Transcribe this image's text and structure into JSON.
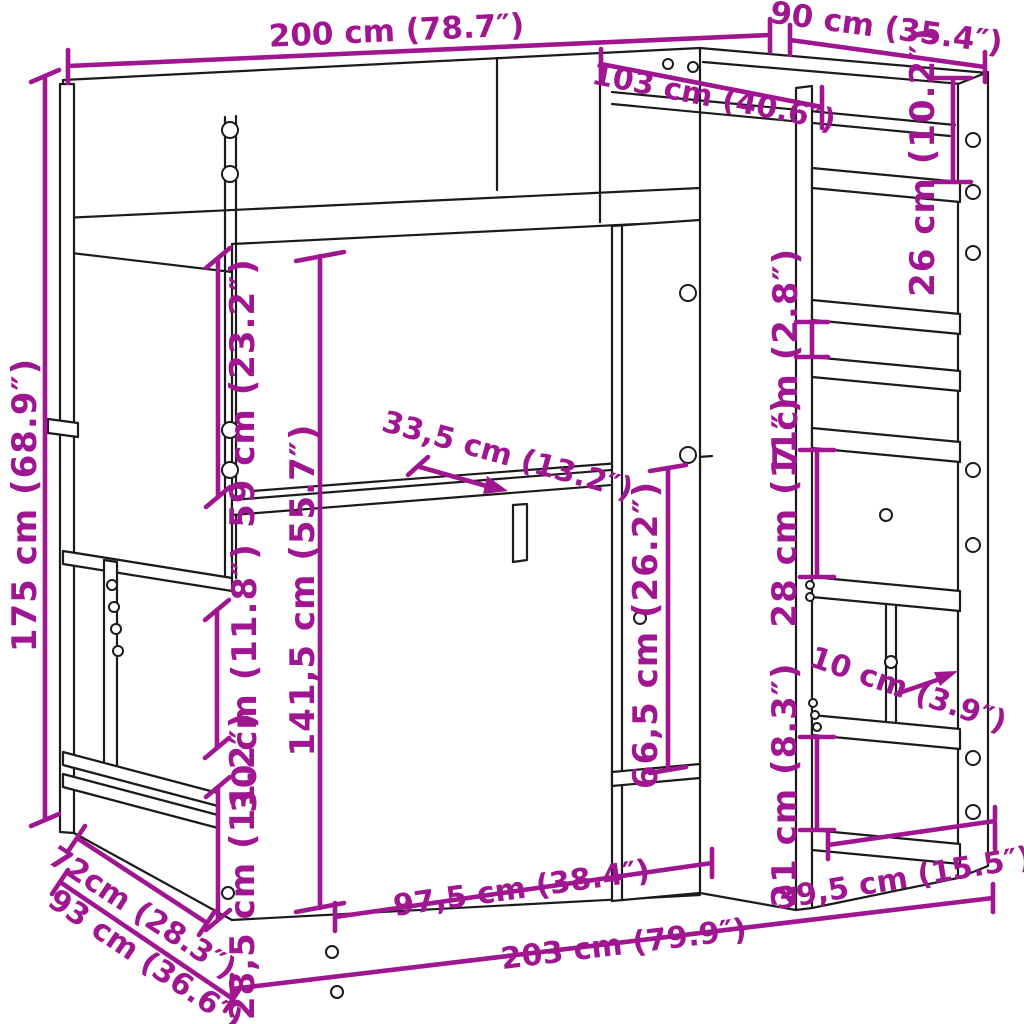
{
  "meta": {
    "subject": "loft-bed-with-desk-and-shelves dimension diagram",
    "background_color": "#ffffff",
    "line_color": "#1b1b1b",
    "dimension_color": "#A01590"
  },
  "dimensions": {
    "bed_top_length": {
      "label": "200 cm (78.7″)"
    },
    "bed_top_depth": {
      "label": "90 cm (35.4″)"
    },
    "inner_length": {
      "label": "103 cm (40.6″)"
    },
    "total_height": {
      "label": "175 cm (68.9″)"
    },
    "top_shelf_gap": {
      "label": "26 cm (10.2″)"
    },
    "headboard_gap": {
      "label": "59 cm (23.2″)"
    },
    "shelf_gap_small": {
      "label": "7 cm (2.8″)"
    },
    "shelf_gap_mid": {
      "label": "28 cm (11″)"
    },
    "underbed_height": {
      "label": "141,5 cm (55.7″)"
    },
    "desk_depth": {
      "label": "33,5 cm (13.2″)"
    },
    "desk_clearance": {
      "label": "66,5 cm (26.2″)"
    },
    "bench_gap_upper": {
      "label": "30 cm (11.8″)"
    },
    "bench_gap_lower": {
      "label": "28,5 cm (11.2″)"
    },
    "shelf_depth": {
      "label": "10 cm (3.9″)"
    },
    "shelf_gap_low": {
      "label": "21 cm (8.3″)"
    },
    "shelf_width": {
      "label": "39,5 cm (15.5″)"
    },
    "desk_width": {
      "label": "97,5 cm (38.4″)"
    },
    "total_length": {
      "label": "203 cm (79.9″)"
    },
    "side_depth_upper": {
      "label": "72cm (28.3″)"
    },
    "side_depth_lower": {
      "label": "93 cm (36.6″)"
    }
  }
}
